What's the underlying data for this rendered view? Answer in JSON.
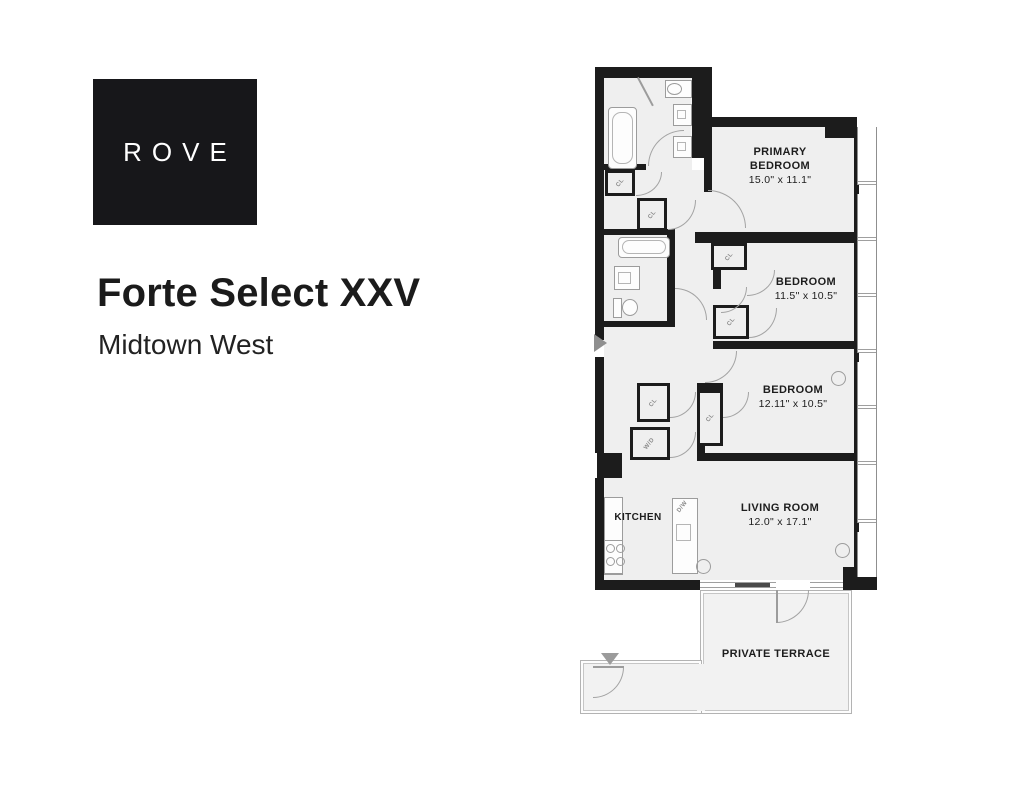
{
  "brand": {
    "logo_text": "ROVE"
  },
  "header": {
    "title": "Forte Select XXV",
    "subtitle": "Midtown West"
  },
  "floorplan": {
    "rooms": [
      {
        "name": "PRIMARY BEDROOM",
        "dims": "15.0\" x 11.1\""
      },
      {
        "name": "BEDROOM",
        "dims": "11.5\" x 10.5\""
      },
      {
        "name": "BEDROOM",
        "dims": "12.11\" x 10.5\""
      },
      {
        "name": "LIVING ROOM",
        "dims": "12.0\" x 17.1\""
      },
      {
        "name": "KITCHEN"
      },
      {
        "name": "PRIVATE TERRACE"
      }
    ],
    "labels": {
      "closet": "CL",
      "washer_dryer": "W/D",
      "dishwasher": "D/W"
    },
    "colors": {
      "wall": "#1c1c1c",
      "floor": "#efefef",
      "fixture_line": "#9c9c9c"
    }
  }
}
